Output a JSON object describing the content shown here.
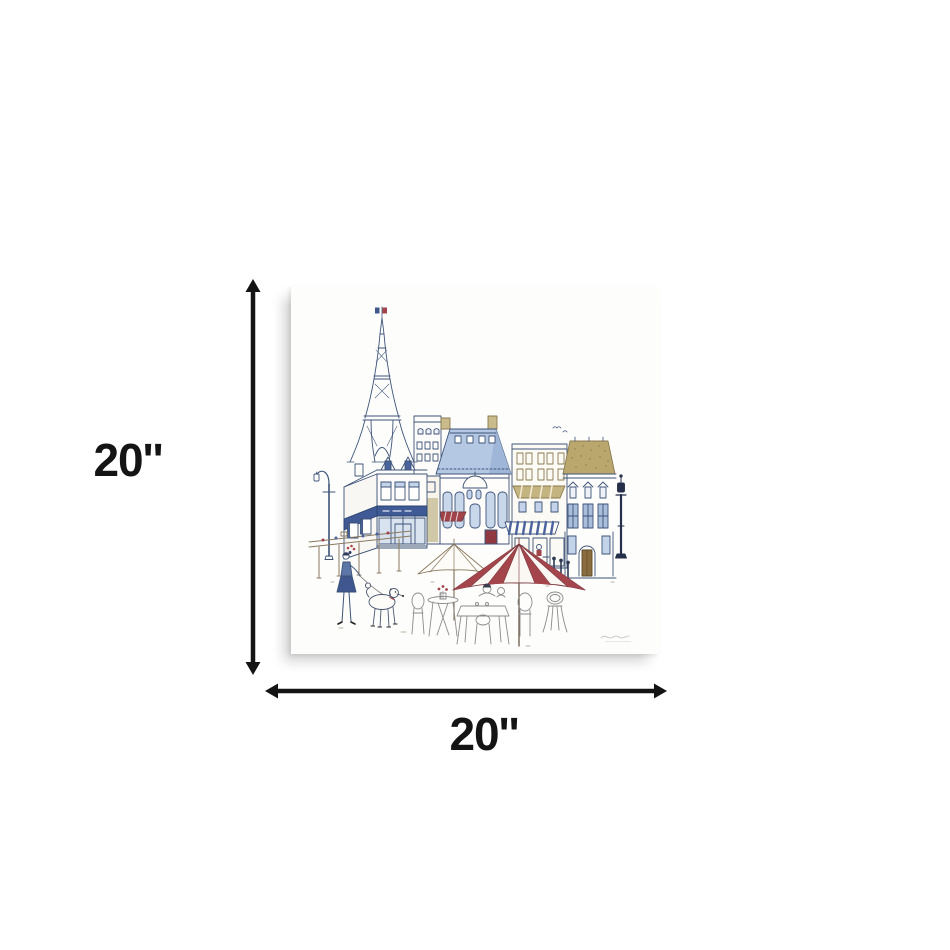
{
  "page": {
    "background_color": "#ffffff"
  },
  "dimensions": {
    "height_label": "20''",
    "width_label": "20''",
    "arrow_color": "#141414"
  },
  "artwork": {
    "name": "paris-street-scene-line-art-canvas-print",
    "canvas_color": "#fdfdfc",
    "palette": {
      "ink_navy": "#3d5378",
      "light_blue": "#b5c8e3",
      "window_blue": "#c3d4ea",
      "accent_blue": "#4b639d",
      "tan_gold": "#baa76e",
      "awning_tan": "#c4b480",
      "red": "#a2434a",
      "dark_red": "#8e3a40",
      "sketch_grey": "#8c8c8c",
      "sepia": "#8a795f"
    },
    "elements": [
      "french-flag",
      "eiffel-tower",
      "paris-buildings",
      "blue-mansard-roof",
      "corner-cafe-building",
      "striped-awnings",
      "street-lamps",
      "white-cafe-umbrella",
      "red-striped-cafe-umbrella",
      "cafe-tables-and-chairs",
      "cafe-patrons",
      "woman-walking-dog",
      "poodle-dog",
      "artist-signature"
    ]
  }
}
